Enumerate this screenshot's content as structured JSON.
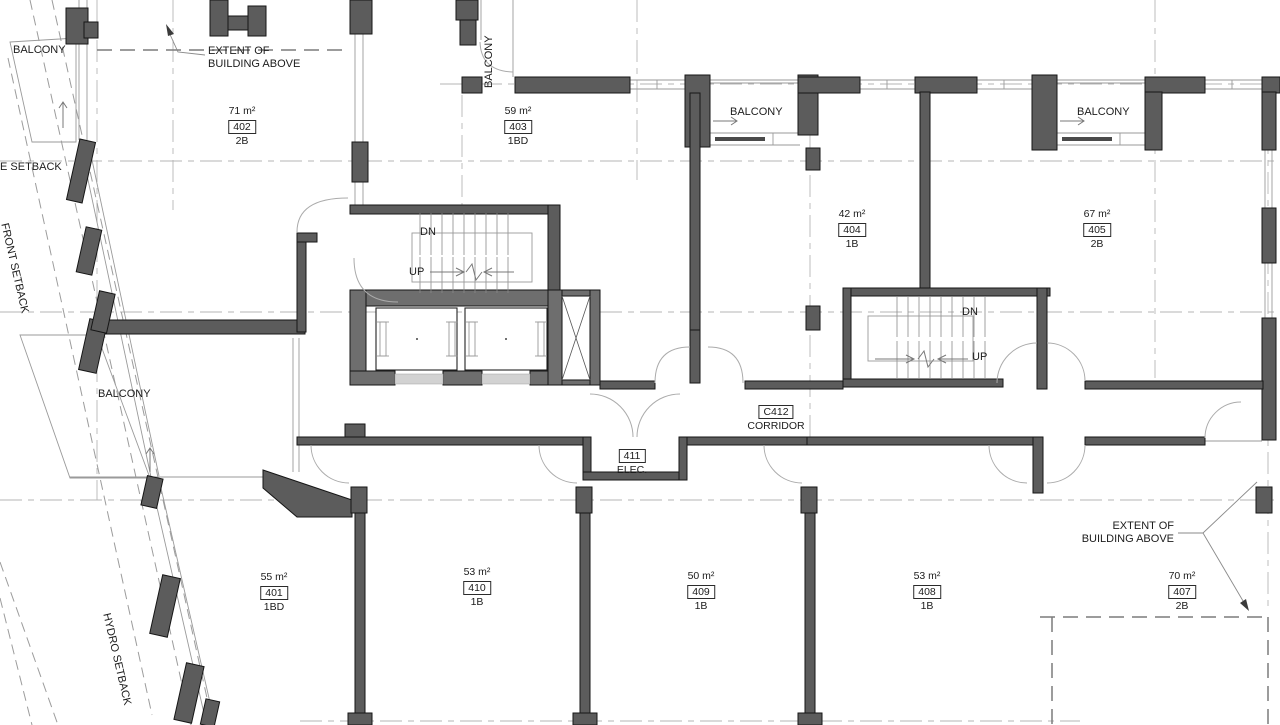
{
  "labels": {
    "balcony": "BALCONY",
    "extent_line1": "EXTENT OF",
    "extent_line2": "BUILDING ABOVE",
    "front_setback": "FRONT SETBACK",
    "side_setback": "E SETBACK",
    "hydro_setback": "HYDRO SETBACK",
    "down": "DN",
    "up": "UP"
  },
  "rooms": {
    "corridor": {
      "id": "C412",
      "name": "CORRIDOR"
    },
    "electrical": {
      "id": "411",
      "name": "ELEC."
    }
  },
  "units": [
    {
      "id": "402",
      "area": "71 m²",
      "type": "2B"
    },
    {
      "id": "403",
      "area": "59 m²",
      "type": "1BD"
    },
    {
      "id": "404",
      "area": "42 m²",
      "type": "1B"
    },
    {
      "id": "405",
      "area": "67 m²",
      "type": "2B"
    },
    {
      "id": "401",
      "area": "55 m²",
      "type": "1BD"
    },
    {
      "id": "410",
      "area": "53 m²",
      "type": "1B"
    },
    {
      "id": "409",
      "area": "50 m²",
      "type": "1B"
    },
    {
      "id": "408",
      "area": "53 m²",
      "type": "1B"
    },
    {
      "id": "407",
      "area": "70 m²",
      "type": "2B"
    }
  ],
  "colors": {
    "wall": "#5c5c5c",
    "core_wall": "#6e6e6e",
    "outline": "#161616",
    "light_line": "#9a9a9a",
    "background": "#ffffff"
  }
}
